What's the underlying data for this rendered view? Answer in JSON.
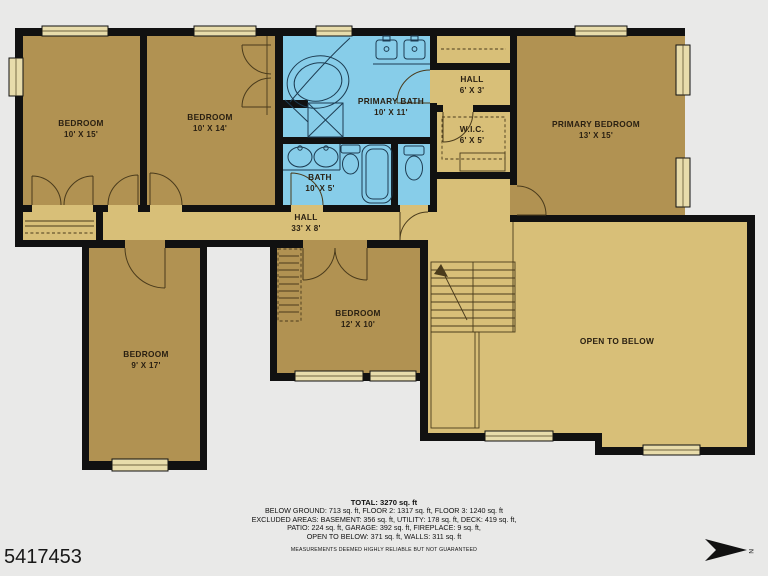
{
  "listing_id": "5417453",
  "compass_label": "N",
  "rooms": [
    {
      "label": "BEDROOM",
      "dims": "10' X 15'"
    },
    {
      "label": "BEDROOM",
      "dims": "10' X 14'"
    },
    {
      "label": "PRIMARY BATH",
      "dims": "10' X 11'"
    },
    {
      "label": "HALL",
      "dims": "6' X 3'"
    },
    {
      "label": "W.I.C.",
      "dims": "6' X 5'"
    },
    {
      "label": "PRIMARY BEDROOM",
      "dims": "13' X 15'"
    },
    {
      "label": "BATH",
      "dims": "10' X 5'"
    },
    {
      "label": "HALL",
      "dims": "33' X 8'"
    },
    {
      "label": "BEDROOM",
      "dims": "12' X 10'"
    },
    {
      "label": "BEDROOM",
      "dims": "9' X 17'"
    },
    {
      "label": "OPEN TO BELOW",
      "dims": ""
    }
  ],
  "footer": {
    "total": "TOTAL: 3270 sq. ft",
    "lines": [
      "BELOW GROUND: 713 sq. ft, FLOOR 2: 1317 sq. ft, FLOOR 3: 1240 sq. ft",
      "EXCLUDED AREAS: BASEMENT: 356 sq. ft, UTILITY: 178 sq. ft, DECK: 419 sq. ft,",
      "PATIO: 224 sq. ft, GARAGE: 392 sq. ft, FIREPLACE: 9 sq. ft,",
      "OPEN TO BELOW: 371 sq. ft, WALLS: 311 sq. ft"
    ],
    "disclaimer": "MEASUREMENTS DEEMED HIGHLY RELIABLE BUT NOT GUARANTEED"
  },
  "colors": {
    "background": "#e9e9e8",
    "walls": "#111111",
    "bedroom_fill": "#b19252",
    "hall_fill": "#d8bf78",
    "bath_fill": "#87cde9",
    "window_fill": "#e8dcab"
  }
}
